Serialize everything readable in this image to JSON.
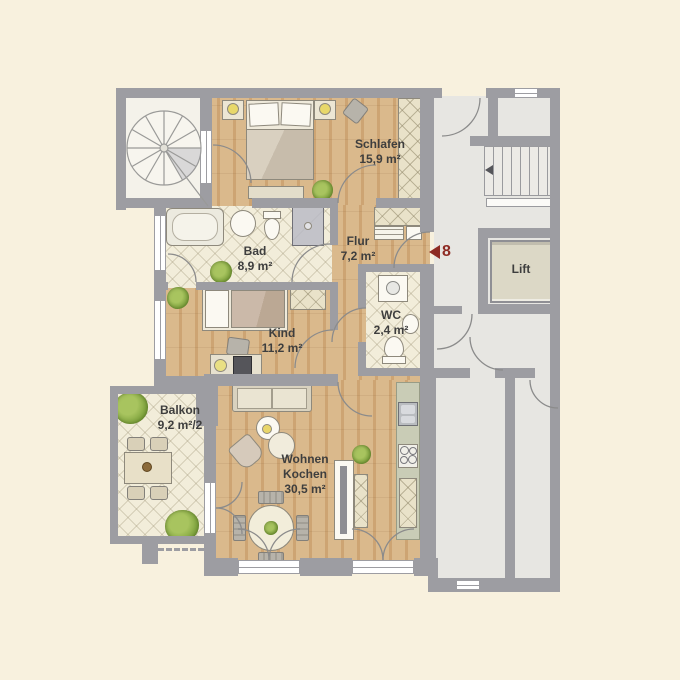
{
  "plan": {
    "title": "apartment-floor-plan",
    "rooms": {
      "schlafen": {
        "name": "Schlafen",
        "area": "15,9 m²"
      },
      "bad": {
        "name": "Bad",
        "area": "8,9 m²"
      },
      "flur": {
        "name": "Flur",
        "area": "7,2 m²"
      },
      "kind": {
        "name": "Kind",
        "area": "11,2 m²"
      },
      "wc": {
        "name": "WC",
        "area": "2,4 m²"
      },
      "wohnen": {
        "name": "Wohnen",
        "name2": "Kochen",
        "area": "30,5 m²"
      },
      "balkon": {
        "name": "Balkon",
        "area": "9,2 m²/2"
      },
      "lift": {
        "name": "Lift"
      }
    },
    "unit_marker": {
      "number": "8"
    },
    "colors": {
      "background": "#f8f1de",
      "wall": "#9d9da2",
      "wood_floor": "#d4ae7f",
      "tile_floor": "#f2edda",
      "neighbor_floor": "#e7e6e2",
      "kitchen_counter": "#c9ccb6",
      "unit_accent": "#8e2b23",
      "plant_green": "#7da23c",
      "label_text": "#3e3e3e"
    }
  }
}
